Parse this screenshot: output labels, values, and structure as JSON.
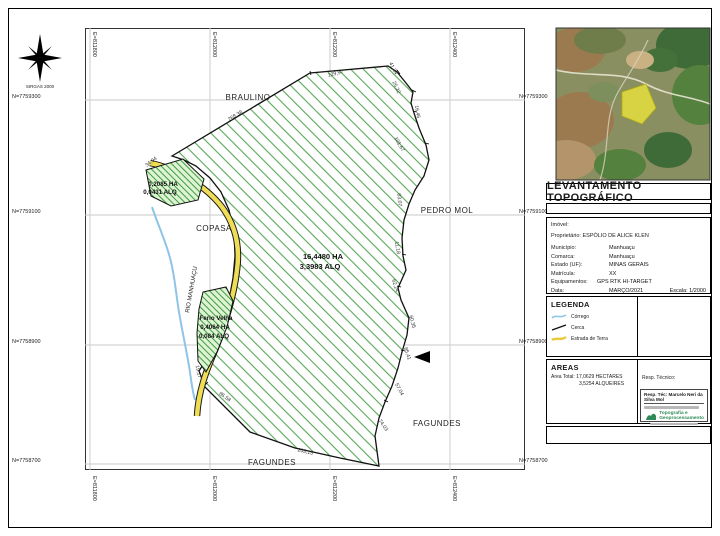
{
  "sheet": {
    "title": "LEVANTAMENTO TOPOGRÁFICO"
  },
  "north_arrow": {
    "caption": "SIRGAS 2000"
  },
  "grid": {
    "north_left": [
      "N=7759300",
      "N=7759100",
      "N=7758900",
      "N=7758700"
    ],
    "north_right": [
      "N=7759300",
      "N=7759100",
      "N=7758900",
      "N=7758700"
    ],
    "east_top": [
      "E=811800",
      "E=812000",
      "E=812200",
      "E=812400"
    ],
    "east_bottom": [
      "E=811800",
      "E=812000",
      "E=812200",
      "E=812400"
    ]
  },
  "map": {
    "neighbors": {
      "top": "BRAULINO",
      "right": "PEDRO MOL",
      "left": "COPASA",
      "bottom_right": "FAGUNDES",
      "bottom": "FAGUNDES"
    },
    "river": "RIO MANHUAÇU",
    "main_parcel": {
      "ha": "16,4480 HA",
      "alq": "3,3983 ALQ"
    },
    "parcel_a": {
      "ha": "0,2085 HA",
      "alq": "0,0431 ALQ"
    },
    "parcel_b": {
      "name": "Ferio Velha",
      "ha": "0,4064 HA",
      "alq": "0,084 ALQ"
    },
    "dimensions": [
      "268,38",
      "129,97",
      "41,34",
      "25,22",
      "16,46",
      "101,67",
      "63,07",
      "11,18",
      "62,24",
      "60,35",
      "85,41",
      "57,04",
      "74,03",
      "203,13",
      "86,58",
      "19,17",
      "34,94"
    ]
  },
  "panel": {
    "info": {
      "imovel": "Imóvel:",
      "proprietario_label": "Proprietário:",
      "proprietario_value": "ESPÓLIO DE ALICE KLEN",
      "rows": [
        {
          "label": "Município:",
          "value": "Manhuaçu"
        },
        {
          "label": "Comarca:",
          "value": "Manhuaçu"
        },
        {
          "label": "Estado (UF):",
          "value": "MINAS GERAIS"
        },
        {
          "label": "Matrícula:",
          "value": "XX"
        }
      ],
      "equip_label": "Equipamentos:",
      "equip_value": "GPS RTK HI-TARGET",
      "data_label": "Data:",
      "data_value": "MARÇO/2021",
      "escala": "Escala: 1/2000"
    },
    "legend": {
      "title": "LEGENDA",
      "items": [
        {
          "label": "Córrego"
        },
        {
          "label": "Cerca"
        },
        {
          "label": "Estrada de Terra"
        }
      ]
    },
    "areas": {
      "title": "AREAS",
      "line1": "Area Total: 17,0629 HECTARES",
      "line2": "3,5254 ALQUEIRES"
    },
    "resp": {
      "label": "Resp. Técnico:",
      "name": "Resp. Téc: Marcelo Neri da Silva Mol",
      "brand_line1": "Topografia e",
      "brand_line2": "Geoprocessamento"
    }
  },
  "colors": {
    "hatch_green": "#58a858",
    "road_yellow": "#efdd55",
    "river_blue": "#8ec4e6",
    "brand_green": "#2e8b57"
  }
}
